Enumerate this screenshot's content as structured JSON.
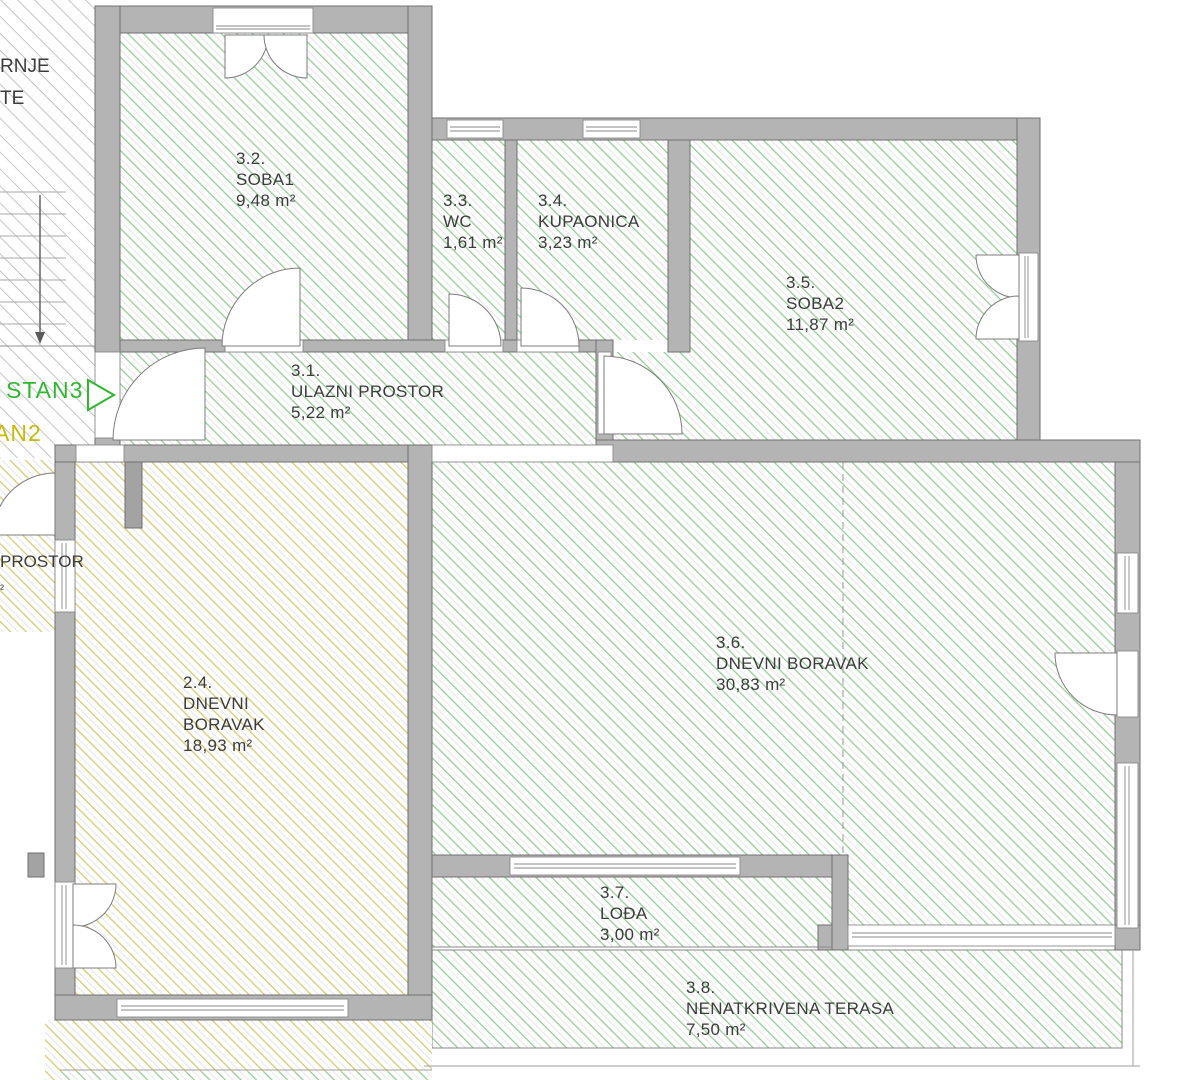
{
  "floor_plan": {
    "apartment_labels": {
      "stan3": {
        "text": "STAN3",
        "color": "#2eb82e"
      },
      "stan2_fragment": {
        "text": "AN2",
        "color": "#c9b90c"
      }
    },
    "stairwell_fragments": {
      "line1": "RNJE",
      "line2": "TE"
    },
    "neighbor_fragment": {
      "name": "PROSTOR",
      "area_sup": "²"
    },
    "rooms": [
      {
        "number": "3.2.",
        "name": "SOBA1",
        "area": "9,48 m²"
      },
      {
        "number": "3.3.",
        "name": "WC",
        "area": "1,61 m²"
      },
      {
        "number": "3.4.",
        "name": "KUPAONICA",
        "area": "3,23 m²"
      },
      {
        "number": "3.5.",
        "name": "SOBA2",
        "area": "11,87 m²"
      },
      {
        "number": "3.1.",
        "name": "ULAZNI PROSTOR",
        "area": "5,22 m²"
      },
      {
        "number": "2.4.",
        "name": "DNEVNI BORAVAK",
        "area": "18,93 m²"
      },
      {
        "number": "3.6.",
        "name": "DNEVNI BORAVAK",
        "area": "30,83 m²"
      },
      {
        "number": "3.7.",
        "name": "LOĐA",
        "area": "3,00 m²"
      },
      {
        "number": "3.8.",
        "name": "NENATKRIVENA TERASA",
        "area": "7,50 m²"
      }
    ]
  },
  "colors": {
    "wall_gray": "#b4b4b4",
    "wall_outline": "#6f6f6f",
    "hatch_green": "#94cf94",
    "hatch_yellow": "#d8ca74",
    "hatch_gray": "#c6c6c6",
    "stan3_green": "#2eb82e",
    "stan2_yellow": "#c9b90c",
    "text": "#3c3c3c"
  }
}
